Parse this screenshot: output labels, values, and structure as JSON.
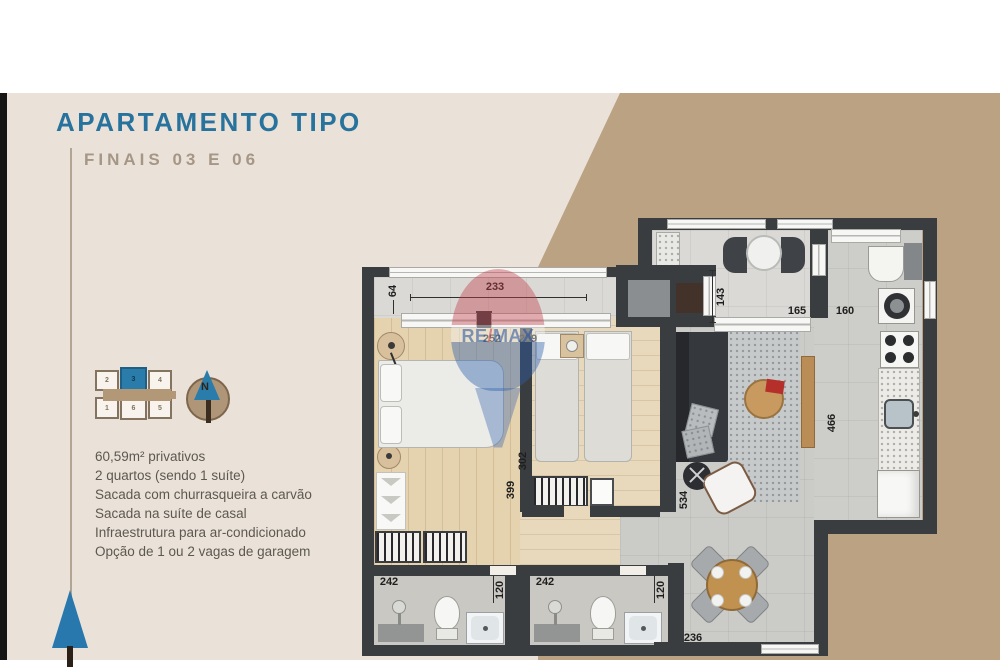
{
  "header": {
    "title": "APARTAMENTO TIPO",
    "subtitle": "FINAIS 03 E 06"
  },
  "features": {
    "items": [
      "60,59m² privativos",
      "2 quartos (sendo 1 suíte)",
      "Sacada com churrasqueira a carvão",
      "Sacada na suíte de casal",
      "Infraestrutura para ar-condicionado",
      "Opção de 1 ou 2 vagas de garagem"
    ]
  },
  "unit_map": {
    "units": [
      "2",
      "3",
      "4",
      "1",
      "6",
      "5"
    ],
    "highlighted_unit": "3"
  },
  "compass": {
    "north_label": "N"
  },
  "watermark": {
    "brand": "RE/MAX",
    "re": "RE",
    "slash": "/",
    "max": "MAX"
  },
  "plan": {
    "dimensions": {
      "suite_balcony_depth": "64",
      "suite_balcony_width": "233",
      "suite_width": "252",
      "bedroom2_width": "239",
      "living_balcony_depth": "143",
      "living_opening": "165",
      "kitchen_opening": "160",
      "kitchen_length": "466",
      "bedroom2_depth": "302",
      "suite_depth": "399",
      "living_depth": "534",
      "bath1_width": "242",
      "bath1_door": "120",
      "bath2_width": "242",
      "bath2_door": "120",
      "dining_width": "236"
    },
    "colors": {
      "wall": "#3a3d3f",
      "accent_blue": "#2a7cab",
      "tan": "#bba283",
      "beige": "#eae2d9"
    }
  }
}
